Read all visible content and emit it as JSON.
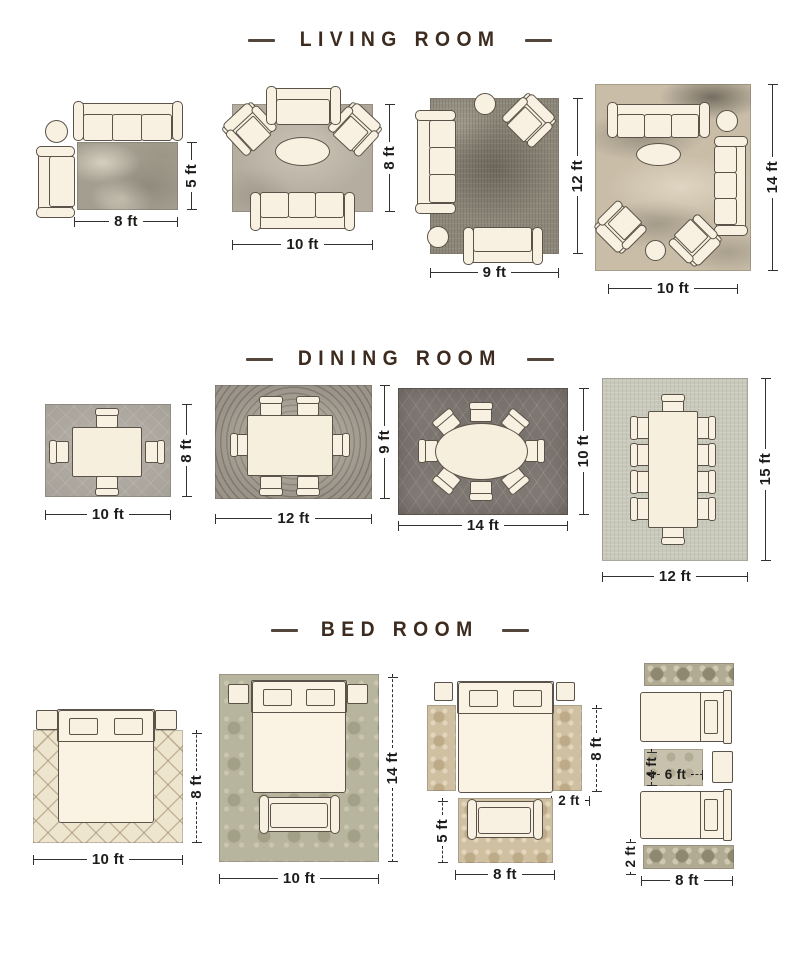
{
  "sections": {
    "living_room": {
      "title": "LIVING ROOM",
      "layouts": [
        {
          "name": "living-8x5",
          "width": "8 ft",
          "height": "5 ft"
        },
        {
          "name": "living-10x8",
          "width": "10 ft",
          "height": "8 ft"
        },
        {
          "name": "living-9x12",
          "width": "9 ft",
          "height": "12 ft"
        },
        {
          "name": "living-10x14",
          "width": "10 ft",
          "height": "14 ft"
        }
      ]
    },
    "dining_room": {
      "title": "DINING ROOM",
      "layouts": [
        {
          "name": "dining-10x8",
          "width": "10 ft",
          "height": "8 ft"
        },
        {
          "name": "dining-12x9",
          "width": "12 ft",
          "height": "9 ft"
        },
        {
          "name": "dining-14x10",
          "width": "14 ft",
          "height": "10 ft"
        },
        {
          "name": "dining-12x15",
          "width": "12 ft",
          "height": "15 ft"
        }
      ]
    },
    "bed_room": {
      "title": "BED ROOM",
      "layouts": [
        {
          "name": "bed-10x8",
          "width": "10 ft",
          "height": "8 ft"
        },
        {
          "name": "bed-10x14",
          "width": "10 ft",
          "height": "14 ft"
        },
        {
          "name": "bed-runners",
          "bed_height": "8 ft",
          "runner_width": "2 ft",
          "rug_height": "5 ft",
          "rug_width": "8 ft"
        },
        {
          "name": "bed-twins",
          "accent_height": "4 ft",
          "accent_width": "6 ft",
          "runner_height": "2 ft",
          "runner_width": "8 ft"
        }
      ]
    }
  },
  "colors": {
    "title_brown": "#3c2b1e",
    "outline": "#5b5349",
    "furniture_cream": "#f8f1e1",
    "dimension_text": "#1d1c1a"
  }
}
